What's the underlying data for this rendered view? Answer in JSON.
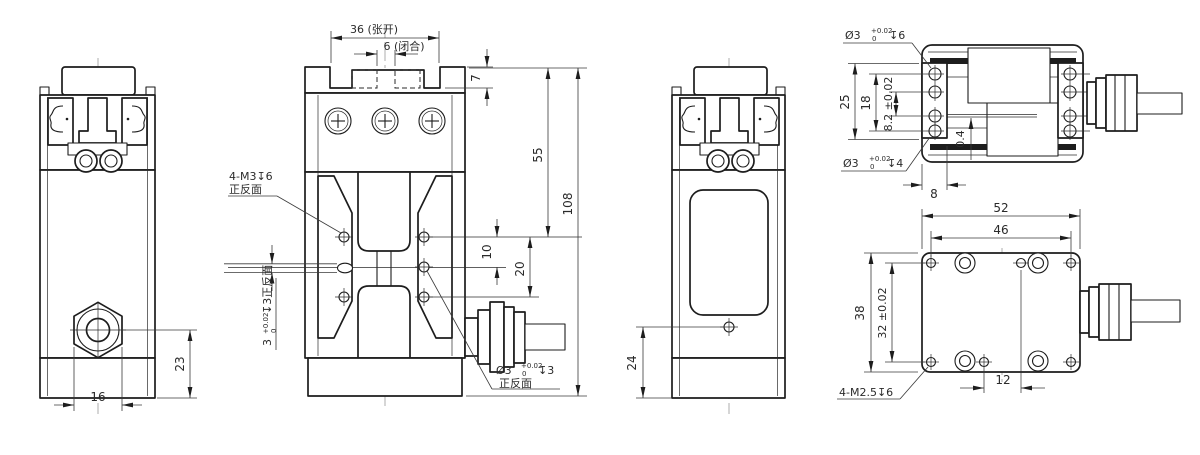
{
  "drawing": {
    "background": "#ffffff",
    "line_color": "#1d1d1d",
    "dim_color": "#3a3a3a",
    "views": {
      "front_left": {
        "dim_23": "23",
        "dim_16": "16"
      },
      "front_main": {
        "dim_open": "36 (张开)",
        "dim_closed": "6 (闭合)",
        "dim_plate": "7",
        "dim_55": "55",
        "dim_108": "108",
        "dim_10": "10",
        "dim_20": "20",
        "thread_note": {
          "line1": "4-M3↧6",
          "line2": "正反面"
        },
        "slot_note": {
          "value": "3",
          "tol_upper": "+0.02",
          "tol_lower": "0",
          "suffix": "↧3正反面"
        },
        "hole_note": {
          "prefix": "Ø3",
          "tol_upper": "+0.02",
          "tol_lower": "0",
          "depth": "↧3",
          "line2": "正反面"
        }
      },
      "side": {
        "dim_24": "24"
      },
      "top": {
        "hole6_note": {
          "prefix": "Ø3",
          "tol_upper": "+0.02",
          "tol_lower": "0",
          "depth": "↧6"
        },
        "hole4_note": {
          "prefix": "Ø3",
          "tol_upper": "+0.02",
          "tol_lower": "0",
          "depth": "↧4"
        },
        "dim_25": "25",
        "dim_18": "18",
        "dim_8_2": "8.2 ±0.02",
        "dim_0_4": "0.4",
        "dim_8": "8"
      },
      "bottom": {
        "dim_52": "52",
        "dim_46": "46",
        "dim_38": "38",
        "dim_32": "32 ±0.02",
        "dim_12": "12",
        "thread_note": "4-M2.5↧6"
      }
    }
  }
}
